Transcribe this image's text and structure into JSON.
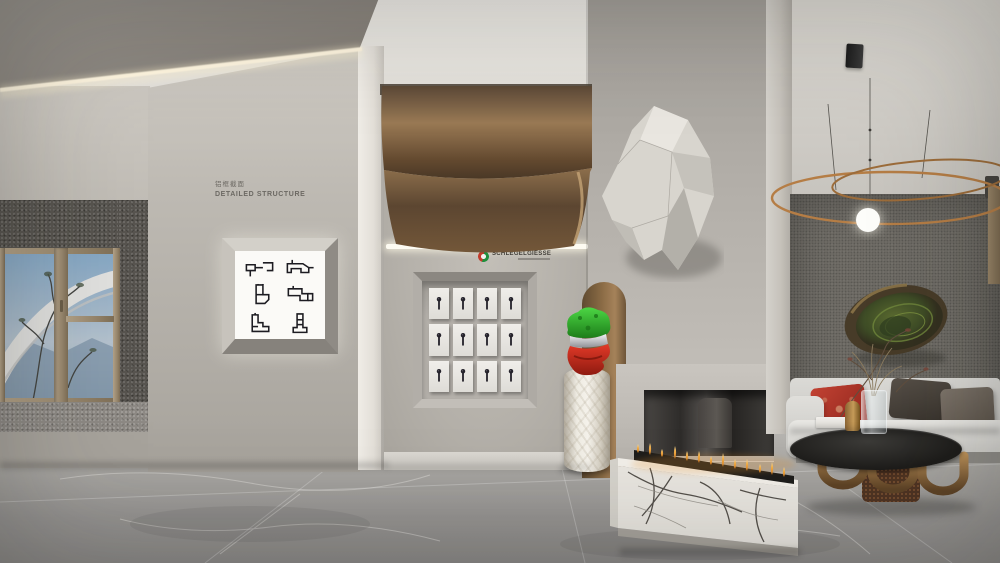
{
  "scene_title": "Aluminum window systems showroom with living area vignette",
  "signage": {
    "line1_zh": "铝框截面",
    "line2_en": "DETAILED STRUCTURE"
  },
  "logo": {
    "brand": "SCHLEGELGIESSE"
  },
  "profile_lightbox": {
    "drawing_count": 6,
    "columns": 2,
    "rows": 3
  },
  "handle_display": {
    "count": 12,
    "columns": 4,
    "rows": 3
  },
  "palette": {
    "bronze_ceiling": "#8a6c49",
    "wall_warm_gray": "#b6b2ab",
    "accent_wall_dark": "#6e6b65",
    "bust_green": "#2fae2c",
    "bust_red": "#cf2b1d",
    "brass": "#a87c46",
    "marble_white": "#e9e6e0",
    "flame_orange": "#e8a33c",
    "copper_ring": "#b57d45",
    "floor_gray": "#9e9c98",
    "sky_blue": "#83a7c5"
  }
}
